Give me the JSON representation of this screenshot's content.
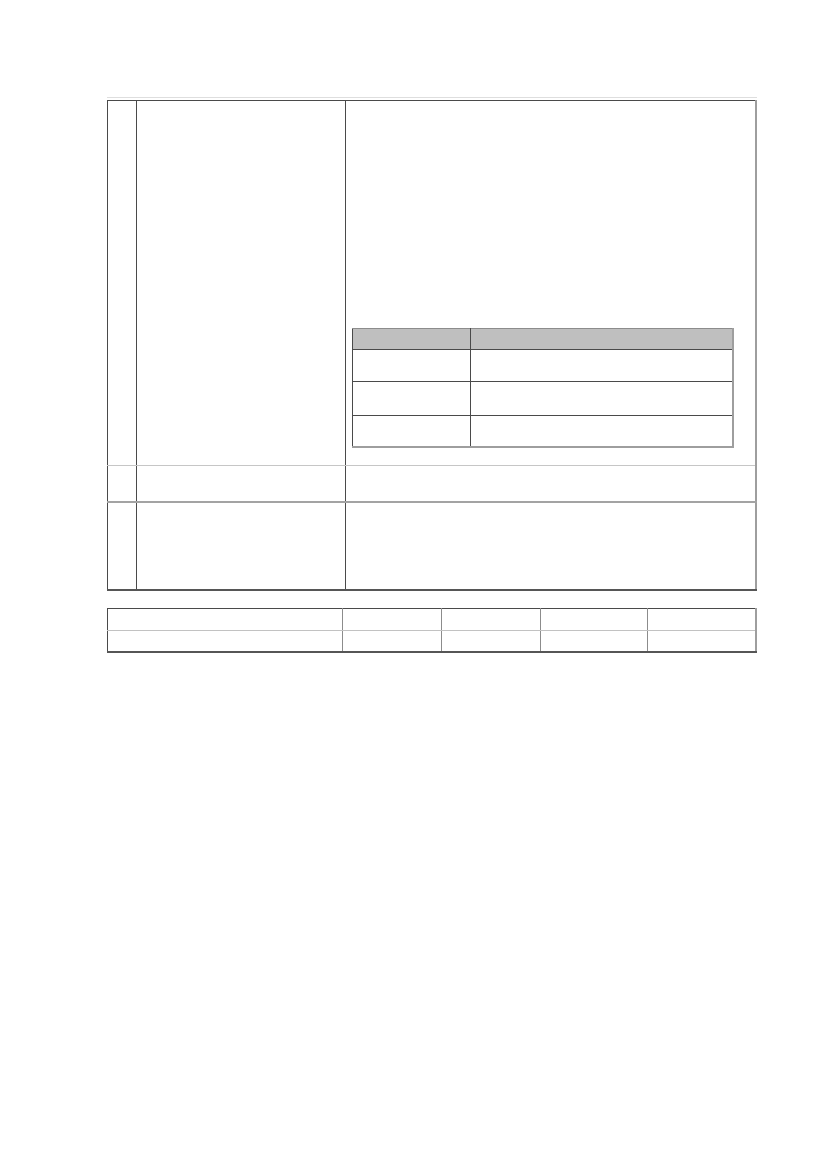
{
  "page": {
    "type": "blank-document-page-with-tables",
    "background": "#ffffff"
  },
  "colors": {
    "page_bg": "#ffffff",
    "border_dark": "#4a4a4a",
    "border_shadow": "#9e9e9e",
    "border_bottom_dark": "#565656",
    "row_sep_light": "#c6c6c6",
    "row_sep_medium": "#a3a3a3",
    "grid_medium": "#8c8c8c",
    "grid_light": "#c2c2c2",
    "header_fill": "#bfbfbf",
    "highlight_line": "#dedede"
  },
  "main_table": {
    "columns": 3,
    "rows": [
      {
        "cells": [
          "",
          "",
          ""
        ]
      },
      {
        "cells": [
          "",
          "",
          ""
        ]
      },
      {
        "cells": [
          "",
          "",
          ""
        ]
      }
    ]
  },
  "nested_table": {
    "columns": 2,
    "header_cells": [
      "",
      ""
    ],
    "rows": [
      {
        "cells": [
          "",
          ""
        ]
      },
      {
        "cells": [
          "",
          ""
        ]
      },
      {
        "cells": [
          "",
          ""
        ]
      }
    ]
  },
  "footer_table": {
    "columns": 5,
    "rows": [
      {
        "cells": [
          "",
          "",
          "",
          "",
          ""
        ]
      },
      {
        "cells": [
          "",
          "",
          "",
          "",
          ""
        ]
      }
    ]
  }
}
